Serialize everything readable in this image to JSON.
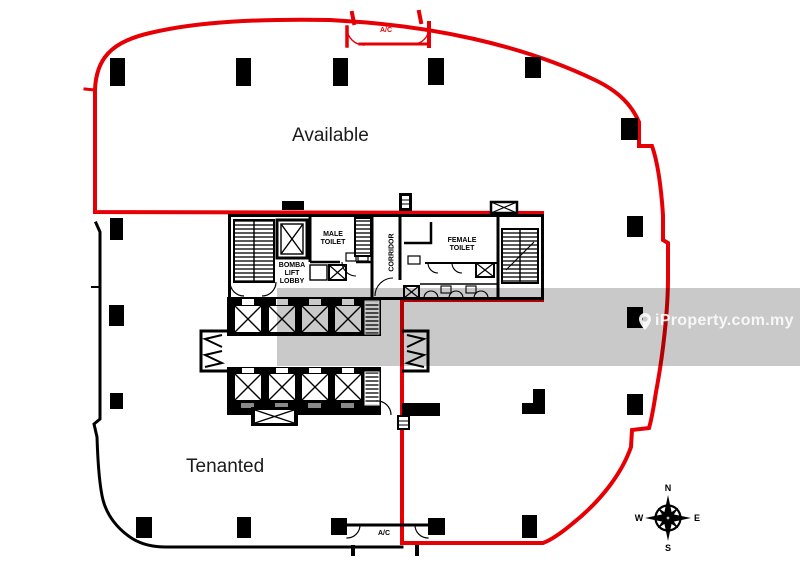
{
  "floor_plan": {
    "areas": {
      "available": "Available",
      "tenanted": "Tenanted"
    },
    "rooms": {
      "male_toilet": "MALE\nTOILET",
      "female_toilet": "FEMALE\nTOILET",
      "corridor": "CORRIDOR",
      "bomba_lift_lobby": "BOMBA\nLIFT\nLOBBY",
      "ac_top": "A/C",
      "ac_bottom": "A/C"
    },
    "colors": {
      "available_boundary": "#e60005",
      "tenanted_boundary": "#000000",
      "plan_ink": "#000000",
      "background": "#ffffff"
    }
  },
  "watermark": {
    "brand": "iProperty.com.my",
    "icon": "location-pin-icon",
    "band_color": "rgba(0,0,0,0.21)",
    "text_color": "#fbfbfb"
  },
  "compass": {
    "north": "N",
    "east": "E",
    "south": "S",
    "west": "W"
  }
}
